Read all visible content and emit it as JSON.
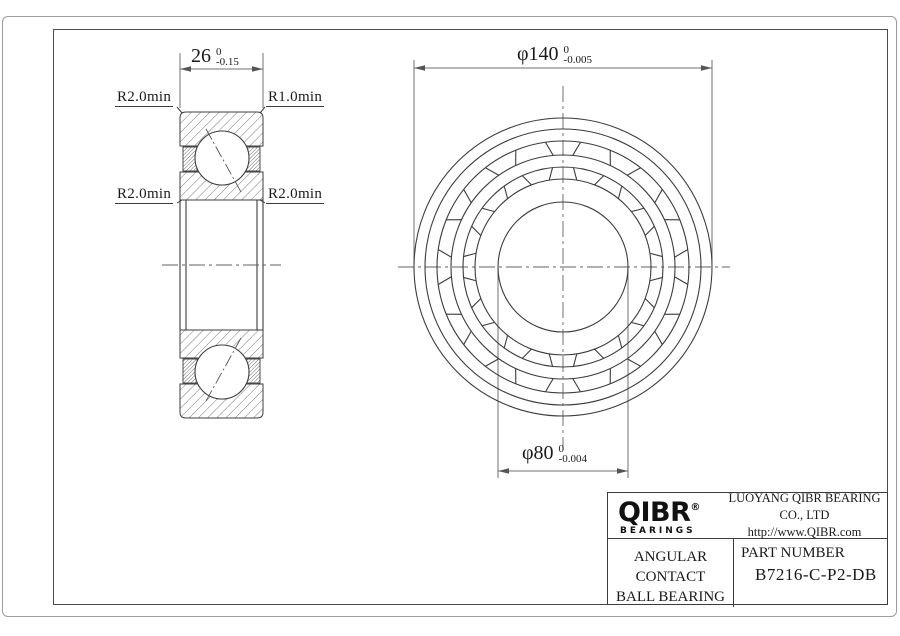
{
  "drawing": {
    "section_view": {
      "width_dim": {
        "value": "26",
        "tol_upper": "0",
        "tol_lower": "-0.15"
      },
      "fillet_top_left": "R2.0min",
      "fillet_top_right": "R1.0min",
      "fillet_mid_left": "R2.0min",
      "fillet_mid_right": "R2.0min"
    },
    "front_view": {
      "od_dim": {
        "symbol": "φ",
        "value": "140",
        "tol_upper": "0",
        "tol_lower": "-0.005"
      },
      "bore_dim": {
        "symbol": "φ",
        "value": "80",
        "tol_upper": "0",
        "tol_lower": "-0.004"
      }
    },
    "title_block": {
      "logo_text": "QIBR",
      "logo_reg": "®",
      "logo_sub": "BEARINGS",
      "company": "LUOYANG QIBR BEARING CO., LTD",
      "website": "http://www.QIBR.com",
      "product_line1": "ANGULAR CONTACT",
      "product_line2": "BALL BEARING",
      "part_label": "PART NUMBER",
      "part_number": "B7216-C-P2-DB"
    },
    "colors": {
      "object_line": "#3c3c3c",
      "dim_line": "#707070",
      "frame_outer": "#9c9c9c",
      "frame_inner": "#4a4a4a"
    }
  }
}
